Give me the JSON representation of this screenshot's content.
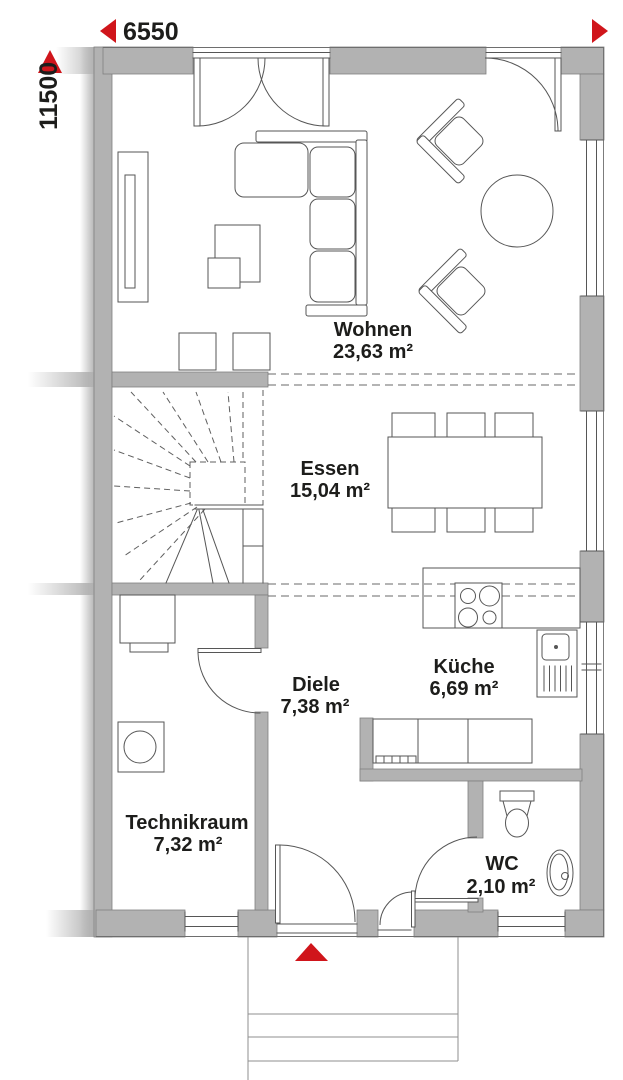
{
  "plan": {
    "dimensions": {
      "width_label": "6550",
      "height_label": "11500"
    },
    "rooms": [
      {
        "name": "Wohnen",
        "area": "23,63 m²"
      },
      {
        "name": "Essen",
        "area": "15,04 m²"
      },
      {
        "name": "Küche",
        "area": "6,69 m²"
      },
      {
        "name": "Diele",
        "area": "7,38 m²"
      },
      {
        "name": "Technikraum",
        "area": "7,32 m²"
      },
      {
        "name": "WC",
        "area": "2,10 m²"
      }
    ],
    "colors": {
      "wall": "#b2b2b2",
      "accent_red": "#d0151b",
      "line": "#565656",
      "text": "#1d1d1b"
    },
    "fixtures": [
      "sofa",
      "coffee-table",
      "stool",
      "wall-unit",
      "armchair",
      "round-table",
      "dining-table",
      "dining-chair",
      "staircase",
      "cooktop",
      "kitchen-sink",
      "kitchen-counter",
      "boiler",
      "washing-machine",
      "toilet",
      "washbasin",
      "porch-steps"
    ]
  }
}
